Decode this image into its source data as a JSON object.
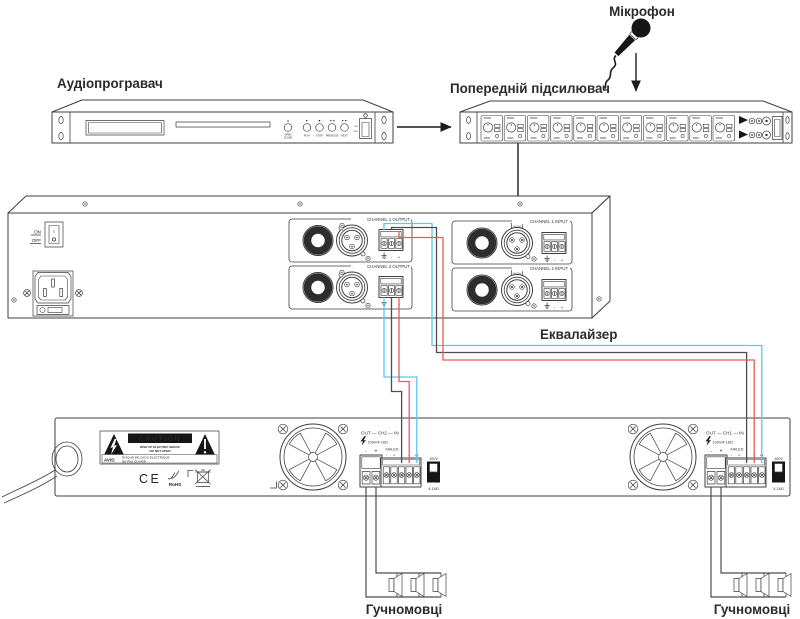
{
  "labels": {
    "microphone": "Мікрофон",
    "audio_player": "Аудіопрогравач",
    "preamp": "Попередній підсилювач",
    "equalizer": "Еквалайзер",
    "speakers_left": "Гучномовці",
    "speakers_right": "Гучномовці"
  },
  "player": {
    "icons": {
      "eject": "▲",
      "play": "►",
      "stop": "■",
      "prev": "◄◄",
      "next": "►►"
    },
    "buttons": {
      "open": "OPEN",
      "close": "CLOSE",
      "play": "PLAY",
      "stop": "STOP",
      "previous": "PREVIOUS",
      "next": "NEXT"
    },
    "power": {
      "on": "ON",
      "off": "OFF"
    }
  },
  "equalizer": {
    "power_on": "ON",
    "power_off": "OFF",
    "switch_i": "I",
    "ch1_output": "CHANNEL 1 OUTPUT",
    "ch2_output": "CHANNEL 2 OUTPUT",
    "ch1_input": "CHANNEL 1 INPUT",
    "ch2_input": "CHANNEL 2 INPUT",
    "push": "PUSH",
    "minus": "-",
    "plus": "+"
  },
  "amplifier": {
    "ch2_title": "OUT — CH2 — IN",
    "ch1_title": "OUT — CH1 — IN",
    "rating": "100V/4-16Ω",
    "failed": "FAILED",
    "minus": "-",
    "plus": "+",
    "ground": "G",
    "switch_top": "100V",
    "switch_bottom": "4-16Ω",
    "caution_title": "CAUTION",
    "caution_line1": "RISK OF ELECTRIC SHOCK",
    "caution_line2": "DO NOT OPEN",
    "avis_label": "AVIS:",
    "avis_line1": "RISQUE DE CHOC ELECTRIQUE",
    "avis_line2": "NE PAS OUVRIR",
    "ce": "CE",
    "rohs": "RoHS"
  },
  "colors": {
    "ground_wire": "#5fc6ee",
    "minus_wire": "#4d4d4d",
    "plus_wire": "#ea5b5b",
    "outline": "#3f3f3f"
  }
}
